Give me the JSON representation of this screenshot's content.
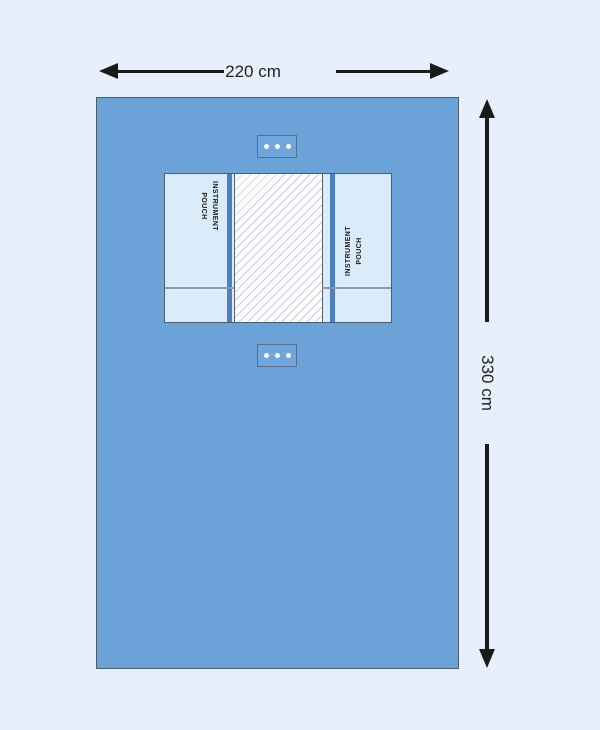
{
  "colors": {
    "background": "#e7effc",
    "drape": "#6ba3d9",
    "drape_border": "#4e5c6b",
    "pouch": "#daecfa",
    "pouch_bar": "#4b7ec2",
    "hatch_bg": "#ffffff",
    "hatch_line": "#c7cae8",
    "hatch_border": "#59636f",
    "divider": "#8b9aa6",
    "tab_fill": "#6fa6db",
    "tab_border": "#5a7089",
    "dot": "#ffffff",
    "arrow": "#1a1a1a",
    "dim_text": "#222222",
    "label_text": "#1b1b1b"
  },
  "dimension_width": {
    "label": "220 cm"
  },
  "dimension_height": {
    "label": "330 cm"
  },
  "drape": {
    "pouch_left": {
      "line1": "INSTRUMENT",
      "line2": "POUCH"
    },
    "pouch_right": {
      "line1": "INSTRUMENT",
      "line2": "POUCH"
    },
    "tab_top": {
      "dot_count": 3
    },
    "tab_bottom": {
      "dot_count": 3
    }
  }
}
